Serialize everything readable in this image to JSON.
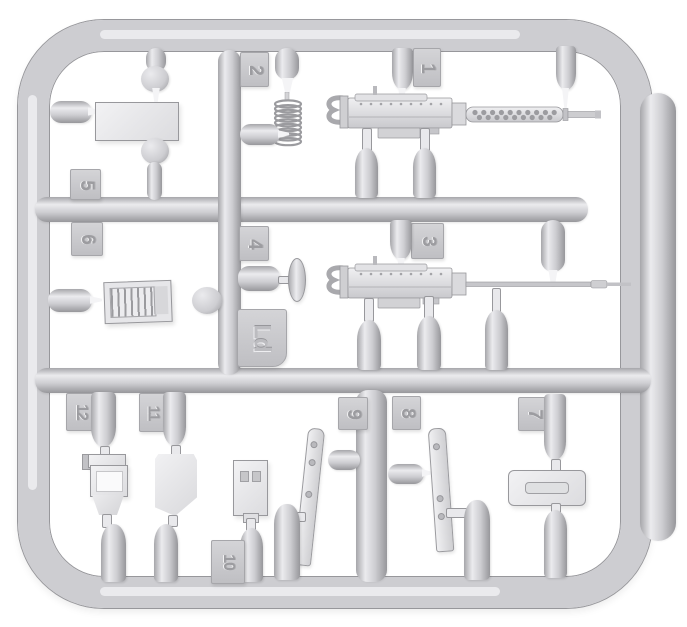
{
  "colors": {
    "bg": "#ffffff",
    "tube": "#cdcdd1",
    "tube_hi": "#ebebee",
    "tube_edge": "#a6a6aa",
    "tube_dark": "#97979b",
    "tab_bg": "#c9c9cd",
    "emboss": "#9c9ca0",
    "part": "#e9e9ec",
    "part_edge": "#98989c",
    "white_tip": "#f4f4f6"
  },
  "tabs": {
    "n1": "1",
    "n2": "2",
    "n3": "3",
    "n4": "4",
    "n5": "5",
    "n6": "6",
    "n7": "7",
    "n8": "8",
    "n9": "9",
    "n10": "10",
    "n11": "11",
    "n12": "12",
    "code": "Ld"
  }
}
